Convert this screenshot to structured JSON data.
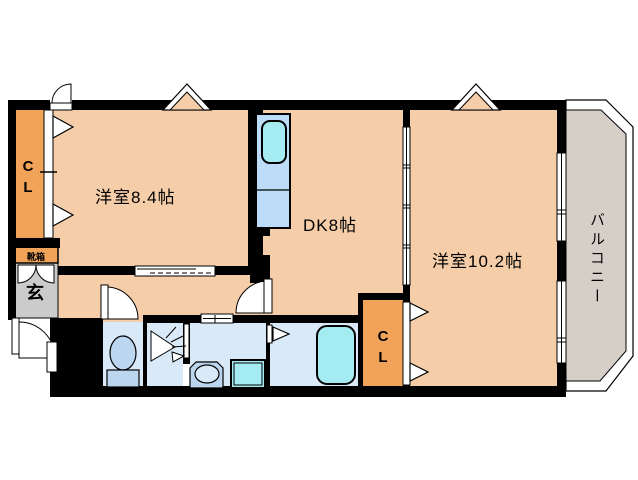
{
  "floorplan": {
    "labels": {
      "room_84": "洋室8.4帖",
      "dk": "DK8帖",
      "room_102": "洋室10.2帖",
      "balcony": "バルコニー",
      "closet_top": "CL",
      "closet_bottom": "CL",
      "entrance": "玄",
      "shoe_box": "靴箱"
    },
    "colors": {
      "wall": "#000000",
      "room_floor": "#F5CDA9",
      "closet_orange": "#F0A359",
      "balcony_floor": "#D6CFC8",
      "entrance_floor": "#CBCBCB",
      "wet_area_floor": "#D9E9F8",
      "fixture_blue": "#BCD6F0",
      "kitchen_counter": "#BCDCF7",
      "sink_tub_cyan": "#A5ECF2",
      "background": "#FFFFFF"
    },
    "fixture_icons": [
      "kitchen-sink-icon",
      "toilet-icon",
      "vanity-sink-icon",
      "bathtub-icon",
      "washing-machine-tap-icon",
      "laundry-pan-icon"
    ]
  }
}
